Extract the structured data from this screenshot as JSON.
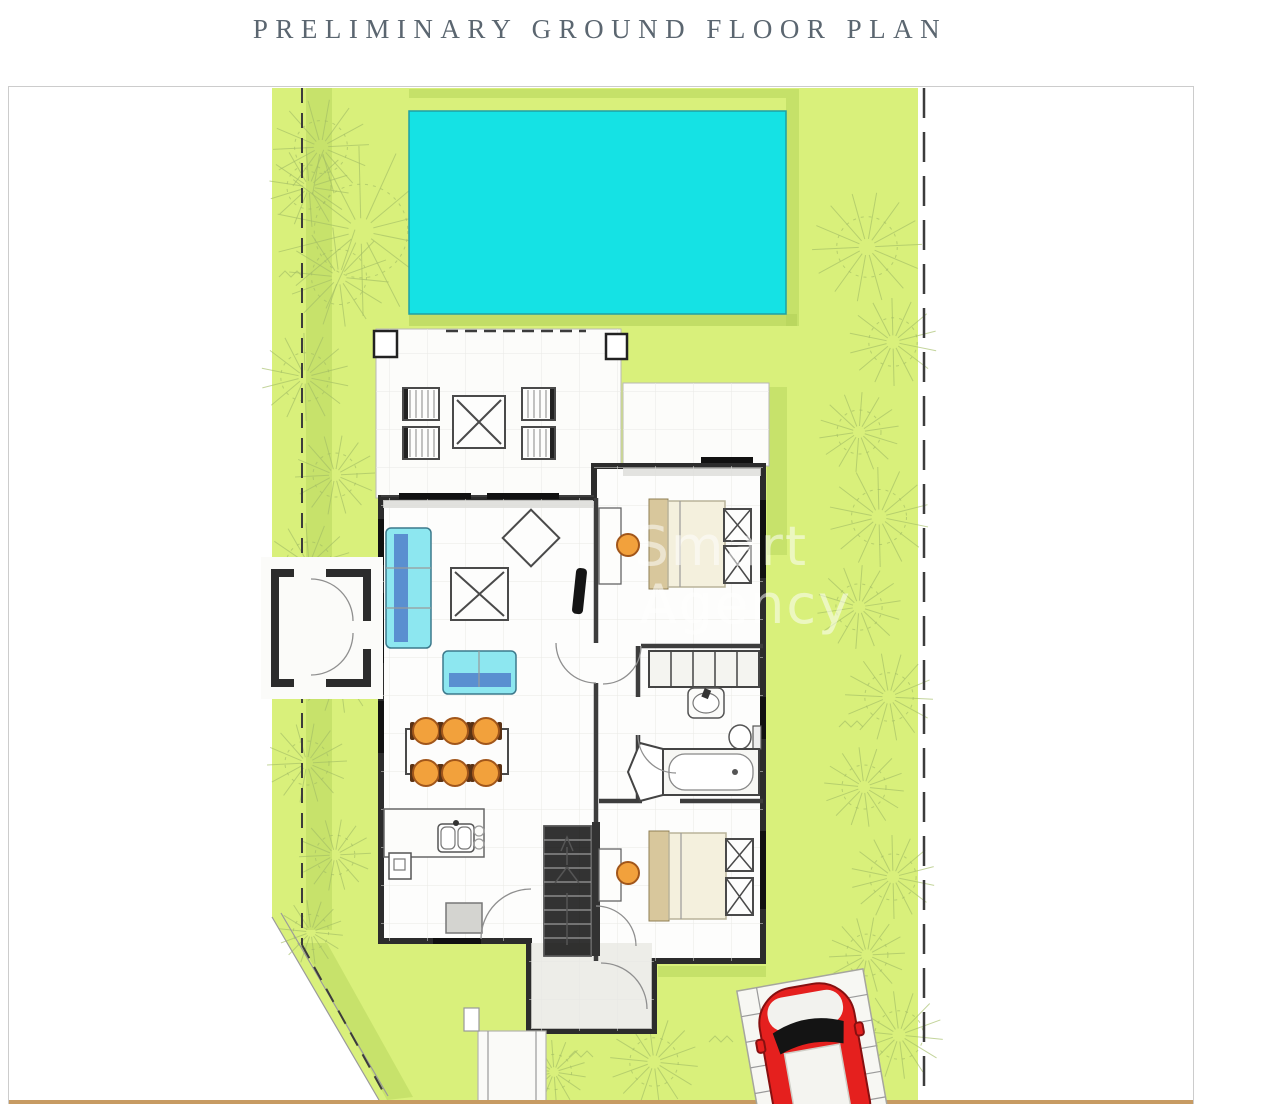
{
  "title": "PRELIMINARY GROUND FLOOR PLAN",
  "watermark": {
    "line1": "Smart",
    "line2": "Agency"
  },
  "colors": {
    "lawn": "#d9f07b",
    "lawn_shade": "#b2d158",
    "pool": "#15e2e4",
    "pool_edge": "#1fa0a3",
    "wall": "#2c2c2c",
    "sofa": "#8de7f0",
    "sofa_accent": "#5a8fd0",
    "chair": "#f2a13c",
    "bed": "#f4f0dd",
    "headboard": "#d8c79c",
    "car": "#e5201e",
    "ground_bar": "#c79b63",
    "boundary": "#3c3c3c",
    "title_text": "#5b6670",
    "watermark_text": "#ffffff"
  },
  "features": [
    "swimming-pool",
    "lawn",
    "property-boundary",
    "terrace",
    "sun-lounger",
    "outdoor-table",
    "sofa",
    "loveseat",
    "coffee-table",
    "armchair",
    "tv",
    "dining-table",
    "dining-chair",
    "kitchen-counter",
    "kitchen-sink",
    "staircase",
    "double-bed",
    "bedside-table",
    "desk",
    "stool",
    "wardrobe",
    "washbasin",
    "toilet",
    "bathtub",
    "entrance-gate",
    "garden-path",
    "parking-pad",
    "red-car",
    "tree-sketch"
  ]
}
